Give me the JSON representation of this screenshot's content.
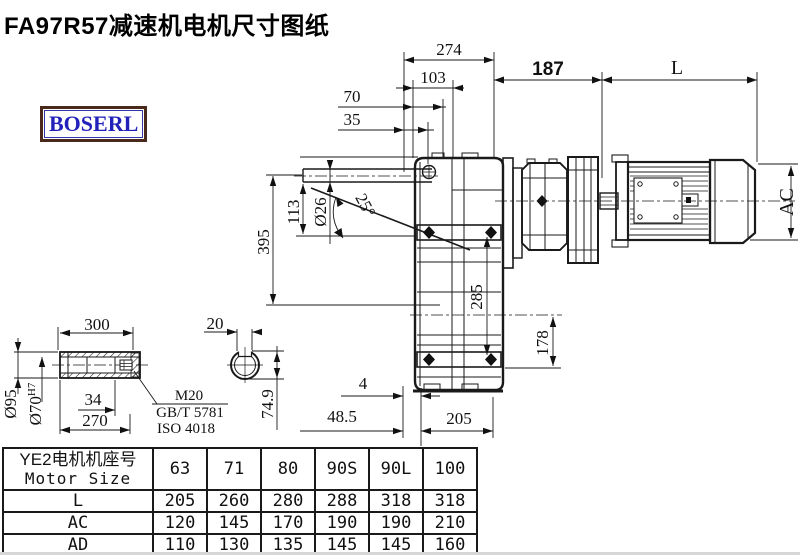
{
  "title": "FA97R57减速机电机尺寸图纸",
  "logo": {
    "text": "BOSERL"
  },
  "colors": {
    "line": "#1a1a1a",
    "logo_text": "#2222bb",
    "logo_border": "#4a281c",
    "background": "#ffffff"
  },
  "dims": {
    "d274": "274",
    "d103": "103",
    "d70": "70",
    "d35": "35",
    "d187": "187",
    "dL": "L",
    "dAC": "AC",
    "d395": "395",
    "d113": "113",
    "d26": "Ø26",
    "a25": "25°",
    "d285": "285",
    "d178": "178",
    "d4": "4",
    "d48p5": "48.5",
    "d205": "205",
    "d300": "300",
    "d95": "Ø95",
    "d70h7": "Ø70",
    "d70h7_sup": "H7",
    "d34": "34",
    "d270": "270",
    "d20": "20",
    "d74p9": "74.9"
  },
  "notes": {
    "m20": "M20",
    "gb": "GB/T 5781",
    "iso": "ISO 4018"
  },
  "table": {
    "header_cn": "YE2电机机座号",
    "header_en": "Motor Size",
    "columns": [
      "63",
      "71",
      "80",
      "90S",
      "90L",
      "100"
    ],
    "rows": [
      {
        "label": "L",
        "values": [
          "205",
          "260",
          "280",
          "288",
          "318",
          "318"
        ]
      },
      {
        "label": "AC",
        "values": [
          "120",
          "145",
          "170",
          "190",
          "190",
          "210"
        ]
      },
      {
        "label": "AD",
        "values": [
          "110",
          "130",
          "135",
          "145",
          "145",
          "160"
        ]
      }
    ]
  }
}
